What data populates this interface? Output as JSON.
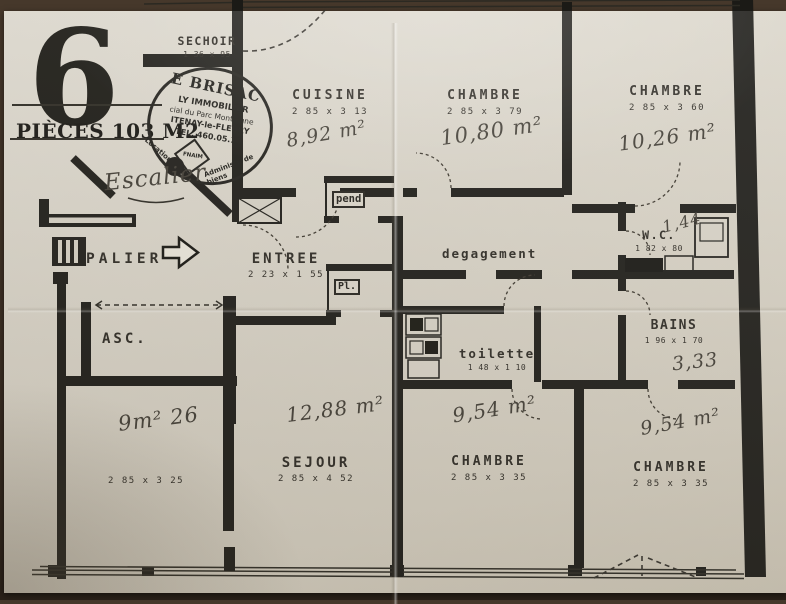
{
  "title_block": {
    "big_number": "6",
    "subtitle": "PIÈCES 103 M2"
  },
  "stamp": {
    "line1": "E BRISAC",
    "line2": "LY IMMOBILIER",
    "line3": "cial du Parc Montaigne",
    "line4": "ITENAY-le-FLEURY",
    "line5": "TEL. 460.05.10",
    "arc_left": "Location",
    "arc_right": "Administr. de biens",
    "badge": "FNAIM"
  },
  "rooms": {
    "sechoir": {
      "name": "SECHOIR",
      "dims": "1 36 x 95"
    },
    "cuisine": {
      "name": "CUISINE",
      "dims": "2 85 x 3 13",
      "area": "8,92 m²"
    },
    "chambre_top_middle": {
      "name": "CHAMBRE",
      "dims": "2 85 x 3 79",
      "area": "10,80 m²"
    },
    "chambre_top_right": {
      "name": "CHAMBRE",
      "dims": "2 85 x 3 60",
      "area": "10,26 m²"
    },
    "escalier": {
      "name": "Escalier"
    },
    "palier": {
      "name": "PALIER"
    },
    "entree": {
      "name": "ENTREE",
      "dims": "2 23 x 1 55"
    },
    "pend": {
      "name": "pend"
    },
    "placard": {
      "name": "Pl."
    },
    "degagement": {
      "name": "degagement"
    },
    "wc": {
      "name": "W.C.",
      "dims": "1 82 x 80",
      "area": "1,44"
    },
    "bains": {
      "name": "BAINS",
      "dims": "1 96 x 1 70",
      "area": "3,33"
    },
    "toilette": {
      "name": "toilette",
      "dims": "1 48 x 1 10"
    },
    "asc": {
      "name": "ASC."
    },
    "chambre_bottom_left": {
      "dims": "2 85 x 3 25",
      "area": "9m² 26"
    },
    "sejour": {
      "name": "SEJOUR",
      "dims": "2 85 x 4 52",
      "area": "12,88 m²"
    },
    "chambre_bottom_middle": {
      "name": "CHAMBRE",
      "dims": "2 85 x 3 35",
      "area": "9,54 m²"
    },
    "chambre_bottom_right": {
      "name": "CHAMBRE",
      "dims": "2 85 x 3 35",
      "area": "9,54 m²"
    }
  }
}
